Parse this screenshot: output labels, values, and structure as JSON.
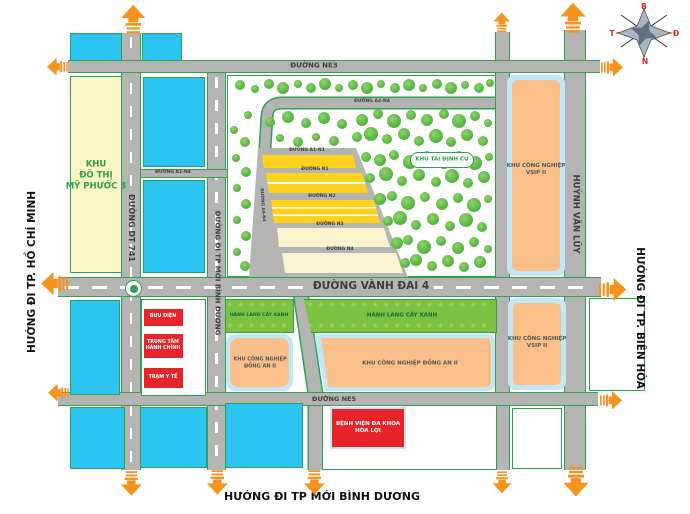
{
  "edge": {
    "left": "HƯỚNG ĐI TP. HỒ CHÍ MINH",
    "right": "HƯỚNG ĐI TP. BIÊN HÒA",
    "bottom": "HƯỚNG ĐI TP MỚI BÌNH DƯƠNG"
  },
  "compass": {
    "north": "B",
    "south": "N",
    "east": "Đ",
    "west": "T"
  },
  "roads": {
    "ne3": "ĐƯỜNG NE3",
    "vanh_dai_4": "ĐƯỜNG VÀNH ĐAI 4",
    "ne5": "ĐƯỜNG NE5",
    "a1_n4": "ĐƯỜNG A1-N4",
    "a4_n4": "ĐƯỜNG A4-N4",
    "dt741": "ĐƯỜNG DT 741",
    "binh_duong": "ĐƯỜNG ĐI TP MỚI BÌNH DƯƠNG",
    "huynh_van_luy": "HUỲNH VĂN LŨY",
    "diagonal": "ĐƯỜNG A4-N4",
    "streets": [
      {
        "label": "ĐƯỜNG A1-N1"
      },
      {
        "label": "ĐƯỜNG N1"
      },
      {
        "label": "ĐƯỜNG N2"
      },
      {
        "label": "ĐƯỜNG N3"
      },
      {
        "label": "ĐƯỜNG N4"
      }
    ]
  },
  "zones": {
    "my_phuoc": "KHU\nĐÔ THỊ\nMỸ PHƯỚC 3",
    "tai_dinh_cu": "KHU TÁI ĐỊNH CƯ",
    "vsip_upper": "KHU CÔNG NGHIỆP\nVSIP II",
    "vsip_lower": "KHU CÔNG NGHIỆP\nVSIP II",
    "hanh_lang_1": "HÀNH LANG CÂY XANH",
    "hanh_lang_2": "HÀNH LANG CÂY XANH",
    "dong_an_1": "KHU CÔNG NGHIỆP\nĐỒNG AN II",
    "dong_an_2": "KHU CÔNG NGHIỆP ĐỒNG AN II",
    "buu_dien": "BƯU ĐIỆN",
    "trung_tam": "TRUNG TÂM\nHÀNH CHÍNH",
    "tram_y_te": "TRẠM Y TẾ",
    "benh_vien": "BỆNH VIỆN ĐA KHOA\nHÒA LỢI"
  },
  "colors": {
    "road": "#b4b5b2",
    "parcel_line": "#2fa24f",
    "water_blue": "#2cc4f0",
    "pale_yellow": "#f9f5c5",
    "gold": "#ffd21c",
    "cream": "#f9f3d0",
    "green_strip": "#7dc142",
    "orange_zone": "#fac089",
    "zone_halo": "#c2e8f7",
    "red_zone": "#e8242b",
    "arrow_orange": "#f6921e",
    "tree_green": "#5cb947",
    "text_green": "#2f9e49",
    "strip_text_green": "#0d6e34"
  },
  "decor": {
    "pattern_char": "✳",
    "trees": [
      [
        240,
        85,
        5
      ],
      [
        255,
        89,
        4
      ],
      [
        269,
        84,
        5
      ],
      [
        283,
        88,
        6
      ],
      [
        298,
        84,
        4
      ],
      [
        311,
        88,
        5
      ],
      [
        325,
        84,
        6
      ],
      [
        339,
        88,
        4
      ],
      [
        353,
        85,
        5
      ],
      [
        367,
        88,
        6
      ],
      [
        381,
        84,
        4
      ],
      [
        395,
        88,
        5
      ],
      [
        409,
        85,
        6
      ],
      [
        423,
        88,
        4
      ],
      [
        437,
        84,
        5
      ],
      [
        451,
        88,
        6
      ],
      [
        465,
        85,
        4
      ],
      [
        479,
        88,
        5
      ],
      [
        490,
        83,
        4
      ],
      [
        248,
        115,
        4
      ],
      [
        270,
        122,
        5
      ],
      [
        288,
        117,
        6
      ],
      [
        306,
        123,
        5
      ],
      [
        324,
        118,
        6
      ],
      [
        342,
        124,
        5
      ],
      [
        280,
        138,
        4
      ],
      [
        298,
        142,
        5
      ],
      [
        316,
        137,
        4
      ],
      [
        334,
        141,
        5
      ],
      [
        234,
        130,
        4
      ],
      [
        245,
        142,
        5
      ],
      [
        236,
        158,
        4
      ],
      [
        246,
        172,
        5
      ],
      [
        237,
        188,
        4
      ],
      [
        246,
        204,
        5
      ],
      [
        237,
        220,
        4
      ],
      [
        246,
        236,
        5
      ],
      [
        237,
        252,
        4
      ],
      [
        245,
        266,
        5
      ],
      [
        362,
        120,
        6
      ],
      [
        378,
        114,
        5
      ],
      [
        394,
        121,
        7
      ],
      [
        411,
        115,
        5
      ],
      [
        427,
        120,
        6
      ],
      [
        444,
        114,
        5
      ],
      [
        459,
        121,
        7
      ],
      [
        475,
        116,
        5
      ],
      [
        488,
        123,
        4
      ],
      [
        357,
        137,
        5
      ],
      [
        371,
        134,
        7
      ],
      [
        387,
        139,
        5
      ],
      [
        404,
        134,
        6
      ],
      [
        419,
        141,
        5
      ],
      [
        436,
        136,
        7
      ],
      [
        451,
        142,
        5
      ],
      [
        467,
        135,
        6
      ],
      [
        483,
        141,
        5
      ],
      [
        366,
        157,
        5
      ],
      [
        380,
        160,
        6
      ],
      [
        394,
        155,
        5
      ],
      [
        410,
        162,
        7
      ],
      [
        427,
        156,
        5
      ],
      [
        444,
        163,
        6
      ],
      [
        459,
        156,
        5
      ],
      [
        475,
        163,
        7
      ],
      [
        489,
        157,
        4
      ],
      [
        370,
        178,
        5
      ],
      [
        386,
        174,
        7
      ],
      [
        402,
        181,
        5
      ],
      [
        419,
        175,
        6
      ],
      [
        436,
        182,
        5
      ],
      [
        452,
        176,
        7
      ],
      [
        468,
        183,
        5
      ],
      [
        484,
        177,
        6
      ],
      [
        380,
        199,
        6
      ],
      [
        392,
        196,
        5
      ],
      [
        408,
        203,
        7
      ],
      [
        425,
        197,
        5
      ],
      [
        442,
        204,
        6
      ],
      [
        458,
        198,
        5
      ],
      [
        474,
        205,
        7
      ],
      [
        488,
        199,
        4
      ],
      [
        388,
        221,
        5
      ],
      [
        400,
        218,
        7
      ],
      [
        416,
        225,
        5
      ],
      [
        433,
        219,
        6
      ],
      [
        450,
        226,
        5
      ],
      [
        466,
        220,
        7
      ],
      [
        482,
        227,
        5
      ],
      [
        397,
        243,
        6
      ],
      [
        408,
        240,
        5
      ],
      [
        424,
        247,
        7
      ],
      [
        441,
        241,
        5
      ],
      [
        458,
        248,
        6
      ],
      [
        474,
        242,
        5
      ],
      [
        488,
        249,
        4
      ],
      [
        405,
        263,
        5
      ],
      [
        416,
        260,
        6
      ],
      [
        432,
        266,
        5
      ],
      [
        448,
        261,
        6
      ],
      [
        464,
        267,
        5
      ],
      [
        480,
        262,
        6
      ]
    ],
    "arrows": [
      [
        133,
        19,
        "up",
        1.1
      ],
      [
        502,
        22,
        "up",
        0.75
      ],
      [
        573,
        18,
        "up",
        1.15
      ],
      [
        57,
        67,
        "left",
        0.8
      ],
      [
        55,
        284,
        "left",
        1.05
      ],
      [
        58,
        393,
        "left",
        0.8
      ],
      [
        612,
        67,
        "right",
        0.85
      ],
      [
        613,
        290,
        "right",
        1.05
      ],
      [
        611,
        400,
        "right",
        0.85
      ],
      [
        131,
        483,
        "down",
        0.95
      ],
      [
        217,
        482,
        "down",
        0.95
      ],
      [
        314,
        482,
        "down",
        0.95
      ],
      [
        502,
        482,
        "down",
        0.85
      ],
      [
        576,
        482,
        "down",
        1.15
      ]
    ]
  }
}
